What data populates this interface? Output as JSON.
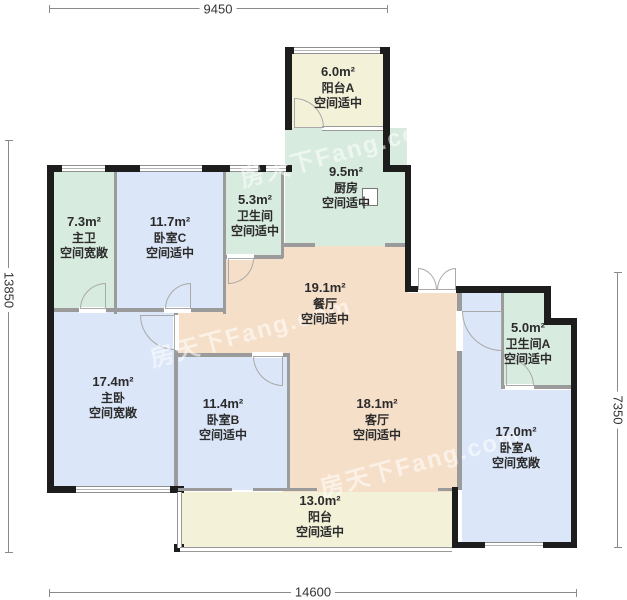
{
  "plan": {
    "title": "户型图",
    "dimensions": {
      "top": "9450",
      "bottom": "14600",
      "left": "13850",
      "right": "7350"
    },
    "watermark": {
      "text": "房天下Fang.com"
    },
    "colors": {
      "bedroom_fill": "#dbe6f8",
      "bath_kitchen_fill": "#d8ebdf",
      "living_dining_fill": "#f5dfc8",
      "balcony_fill": "#f3f1d8",
      "exterior_wall": "#1d1d1d",
      "interior_wall": "#9b9b9b"
    },
    "rooms": [
      {
        "id": "master-bath",
        "area": "7.3m²",
        "name": "主卫",
        "note": "空间宽敞"
      },
      {
        "id": "bedroom-c",
        "area": "11.7m²",
        "name": "卧室C",
        "note": "空间适中"
      },
      {
        "id": "bathroom",
        "area": "5.3m²",
        "name": "卫生间",
        "note": "空间适中"
      },
      {
        "id": "balcony-a",
        "area": "6.0m²",
        "name": "阳台A",
        "note": "空间适中"
      },
      {
        "id": "kitchen",
        "area": "9.5m²",
        "name": "厨房",
        "note": "空间适中"
      },
      {
        "id": "dining",
        "area": "19.1m²",
        "name": "餐厅",
        "note": "空间适中"
      },
      {
        "id": "master-bedroom",
        "area": "17.4m²",
        "name": "主卧",
        "note": "空间宽敞"
      },
      {
        "id": "bedroom-b",
        "area": "11.4m²",
        "name": "卧室B",
        "note": "空间适中"
      },
      {
        "id": "living",
        "area": "18.1m²",
        "name": "客厅",
        "note": "空间适中"
      },
      {
        "id": "balcony",
        "area": "13.0m²",
        "name": "阳台",
        "note": "空间适中"
      },
      {
        "id": "bathroom-a",
        "area": "5.0m²",
        "name": "卫生间A",
        "note": "空间适中"
      },
      {
        "id": "bedroom-a",
        "area": "17.0m²",
        "name": "卧室A",
        "note": "空间宽敞"
      }
    ]
  }
}
